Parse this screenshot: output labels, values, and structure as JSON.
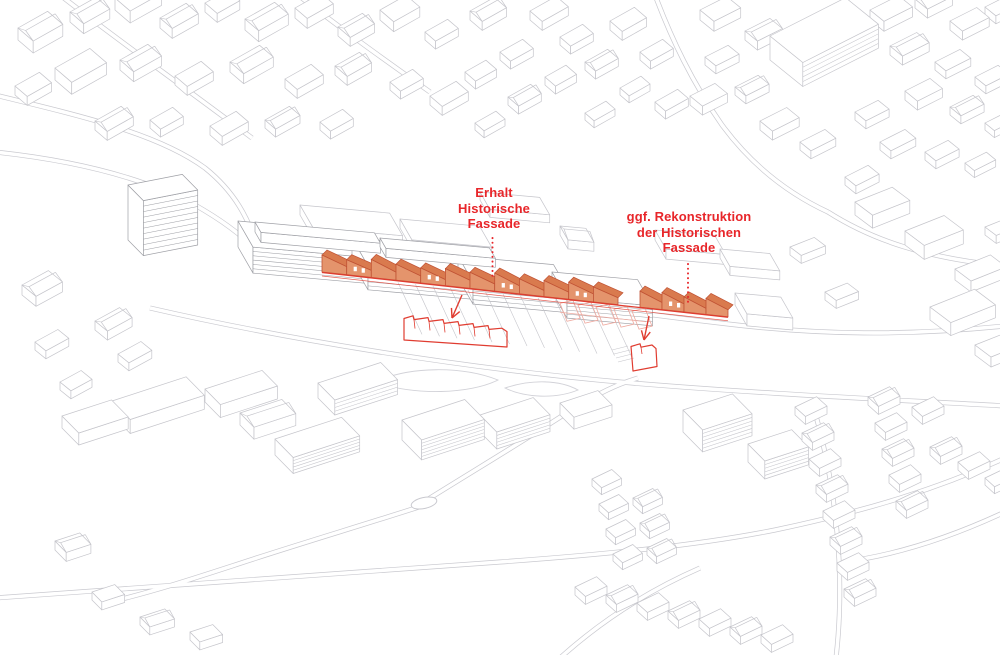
{
  "annotations": {
    "erhalt": {
      "line1": "Erhalt",
      "line2": "Historische",
      "line3": "Fassade"
    },
    "rekonstruktion": {
      "line1": "ggf. Rekonstruktion",
      "line2": "der Historischen",
      "line3": "Fassade"
    }
  },
  "colors": {
    "annotation_red": "#e8262a",
    "facade_fill": "#e4946c",
    "facade_roof": "#d97a4e",
    "facade_stroke": "#c05234",
    "outline_red": "#e03c30",
    "wireframe_pink": "#efaaa0",
    "linework_gray": "#c5c5cb",
    "site_gray": "#9fa0a6",
    "road_gray": "#c9c9cf",
    "landscape_gray": "#d2d2d8",
    "background": "#ffffff"
  }
}
